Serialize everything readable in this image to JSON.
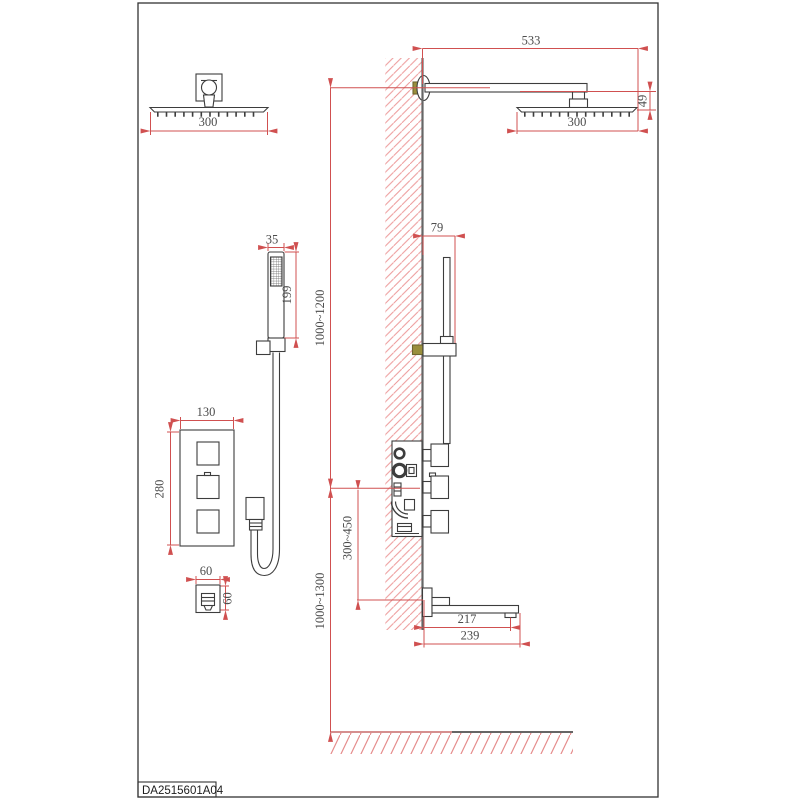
{
  "title_block": {
    "code": "DA2515601A04"
  },
  "dimensions": {
    "head_front_width": "300",
    "arm_length": "533",
    "head_drop": "49",
    "head_side_width": "300",
    "handshower_width": "35",
    "handshower_length": "199",
    "valve_plate_width": "130",
    "valve_plate_height": "280",
    "outlet_width": "60",
    "outlet_height": "60",
    "slidebar_offset": "79",
    "arm_height_range": "1000~1200",
    "valve_height_range": "1000~1300",
    "valve_to_spout_range": "300~450",
    "spout_reach": "217",
    "spout_length": "239"
  },
  "colors": {
    "dimension_red": "#d05050",
    "hatch_red": "#ec9898",
    "outline_gray": "#3d3d3d",
    "wall_face_gray": "#666666",
    "fitting_olive": "#9a8f3c"
  }
}
